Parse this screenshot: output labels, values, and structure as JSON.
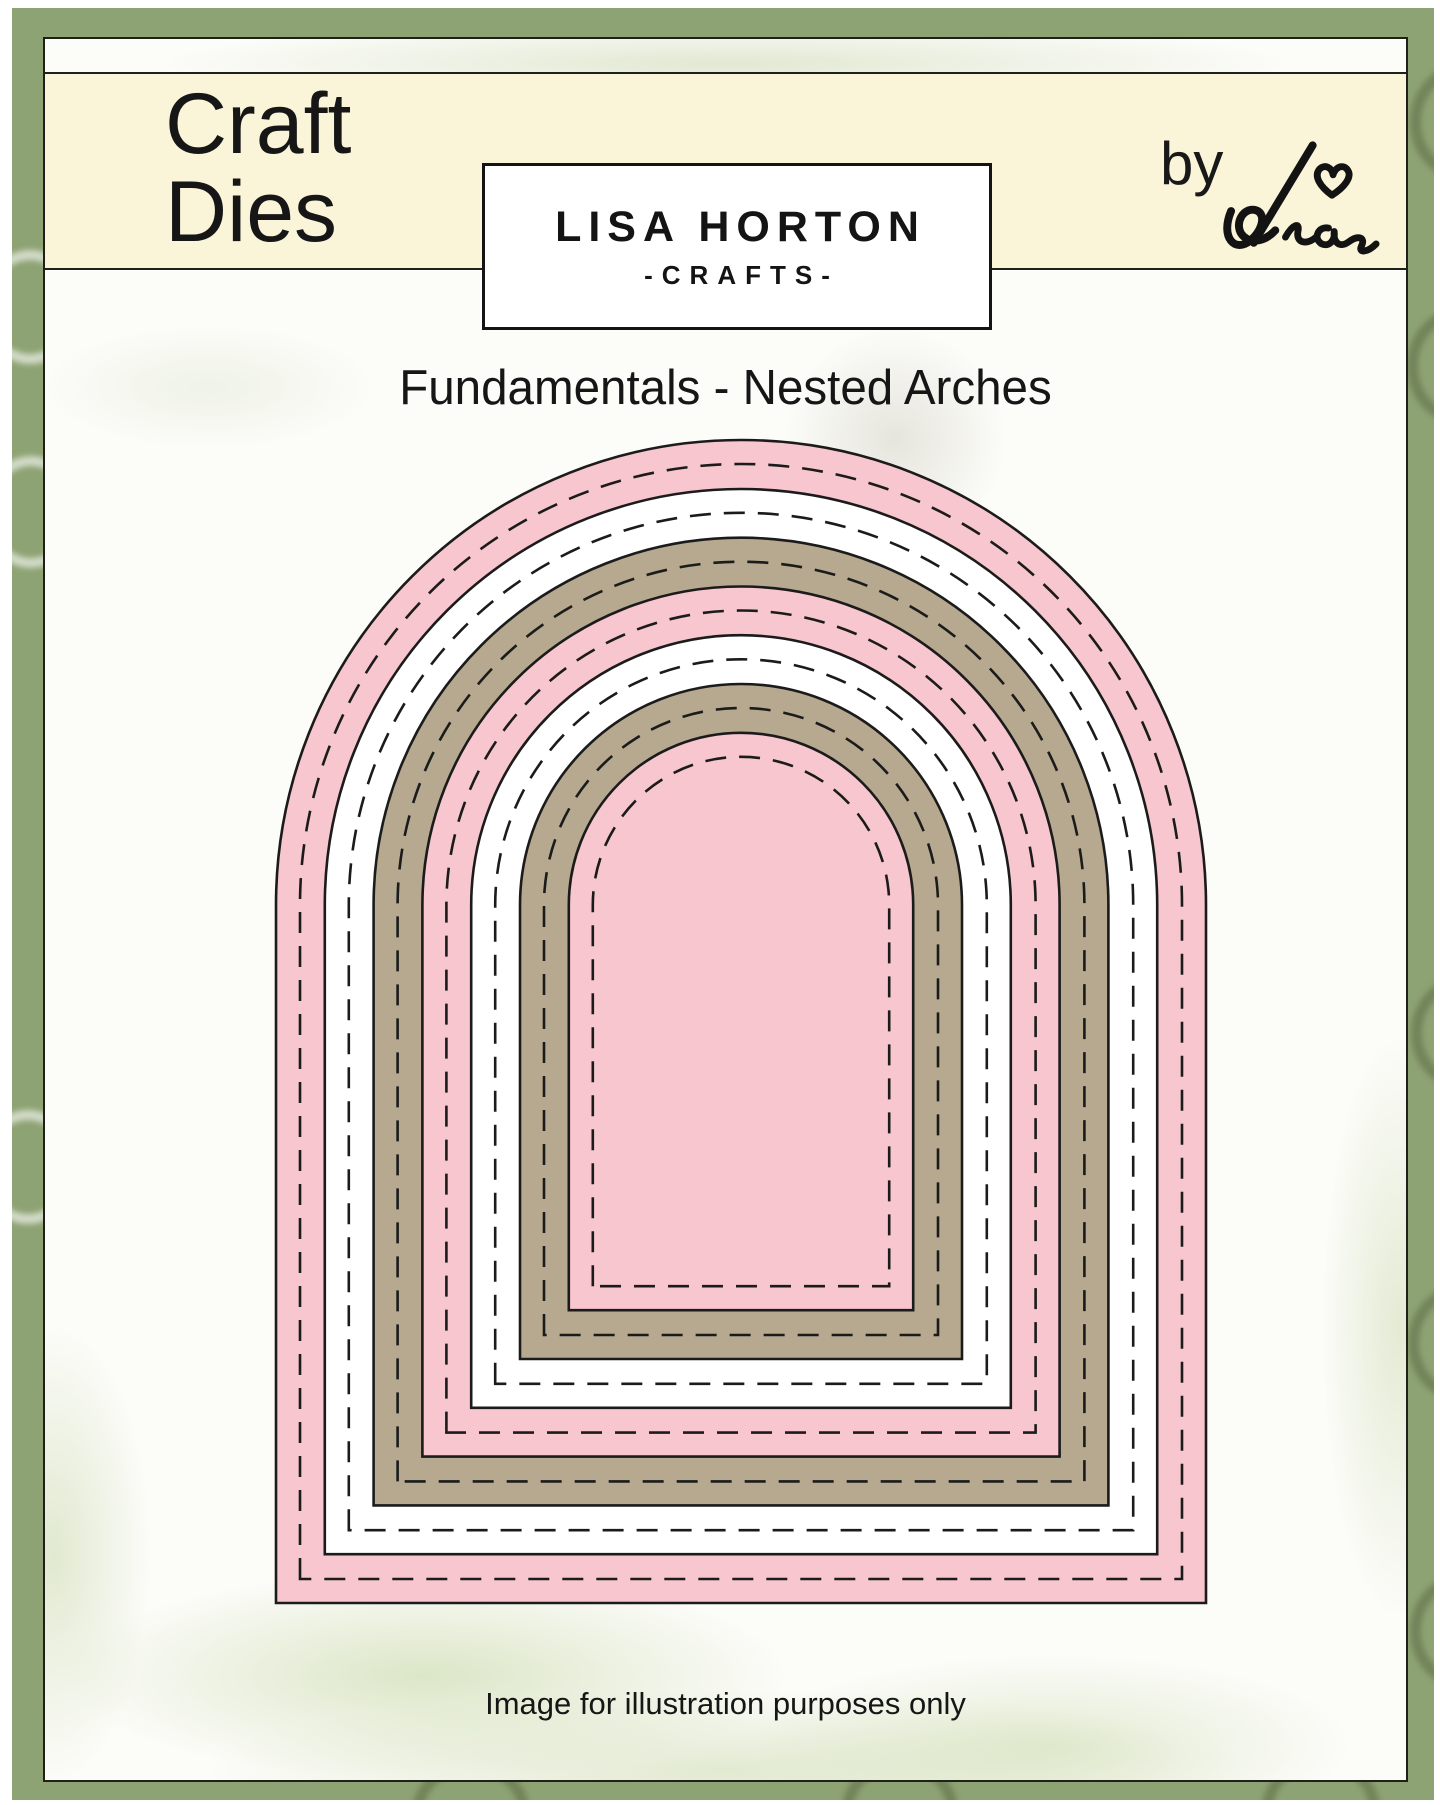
{
  "header": {
    "product_type_line1": "Craft",
    "product_type_line2": "Dies"
  },
  "brand": {
    "name": "LISA HORTON",
    "tagline": "-CRAFTS-",
    "byline_prefix": "by",
    "byline_signature": "Lisa"
  },
  "product": {
    "title": "Fundamentals - Nested Arches"
  },
  "footer": {
    "disclaimer": "Image for illustration purposes only"
  },
  "colors": {
    "frame_green": "#8EA373",
    "cream_band": "#FAF5D8",
    "sheet_white": "#fcfcf9",
    "die_pink": "#F8C6CE",
    "die_white": "#FFFFFF",
    "die_tan": "#B6A98F",
    "outline_black": "#1B1B1B"
  },
  "arches": {
    "count": 7,
    "description": "nested stitched arch dies, outermost to innermost",
    "layer_colors": [
      "#F8C6CE",
      "#FFFFFF",
      "#B6A98F",
      "#F8C6CE",
      "#FFFFFF",
      "#B6A98F",
      "#F8C6CE"
    ],
    "outer": {
      "left": 262,
      "top": 430,
      "right": 1192,
      "bottom": 1593
    },
    "step": 48.8,
    "stitch_inset": 24,
    "outline_color": "#1B1B1B",
    "outline_width": 2.6,
    "stitch_width": 2.6,
    "stitch_dash": "21 13"
  }
}
